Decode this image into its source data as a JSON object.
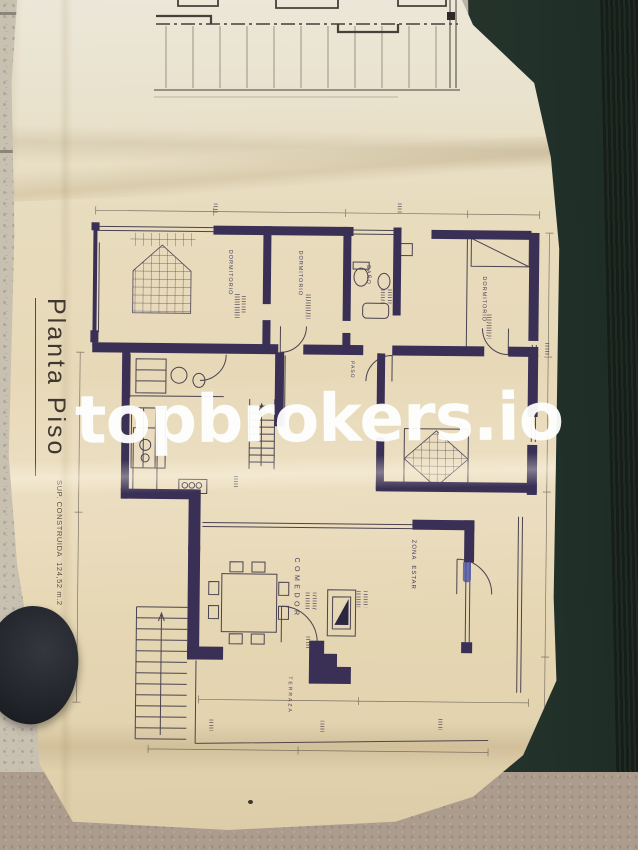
{
  "watermark": {
    "text": "topbrokers.io"
  },
  "plan": {
    "title": "Planta Piso",
    "area_label": "SUP. CONSTRUIDA  124,52 m.2",
    "rooms": {
      "dormitorio_left": "DORMITORIO",
      "dormitorio_mid": "DORMITORIO",
      "dormitorio_right": "DORMITORIO",
      "bano": "BAÑO",
      "paso": "PASO",
      "comedor": "COMEDOR",
      "zona_estar": "ZONA  ESTAR",
      "terraza": "TERRAZA"
    }
  },
  "colors": {
    "paper": "#e8dcbe",
    "paper-light": "#ece7d9",
    "wall-ink": "#3a3055",
    "line-ink": "#4a4350",
    "watermark": "#ffffff",
    "mat": "#25332b",
    "mat-dark": "#161e19",
    "tile": "#c8c0b1",
    "tile-warm": "#ab9c8e",
    "shoe": "#23262c",
    "pen-blue": "#4a52a8"
  }
}
